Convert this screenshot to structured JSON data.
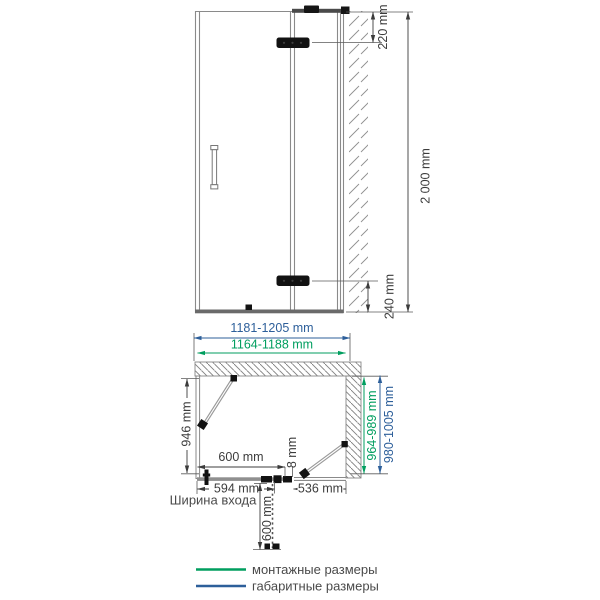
{
  "elevation": {
    "height": "2 000 mm",
    "top_hinge_offset": "220 mm",
    "bottom_hinge_offset": "240 mm"
  },
  "plan": {
    "overall_width": "1181-1205 mm",
    "mounting_width": "1164-1188 mm",
    "mounting_depth": "964-989 mm",
    "overall_depth": "980-1005 mm",
    "side_panel_depth": "946 mm",
    "door_width": "600 mm",
    "entrance_width": "594 mm",
    "entrance_width_label": "Ширина входа",
    "fixed_panel_width": "536 mm",
    "glass_thickness": "8 mm",
    "door_opening_depth": "600 mm"
  },
  "legend": {
    "mounting_dimensions_label": "монтажные размеры",
    "overall_dimensions_label": "габаритные размеры",
    "mounting_color": "#009E5F",
    "overall_color": "#2D5F9A"
  }
}
